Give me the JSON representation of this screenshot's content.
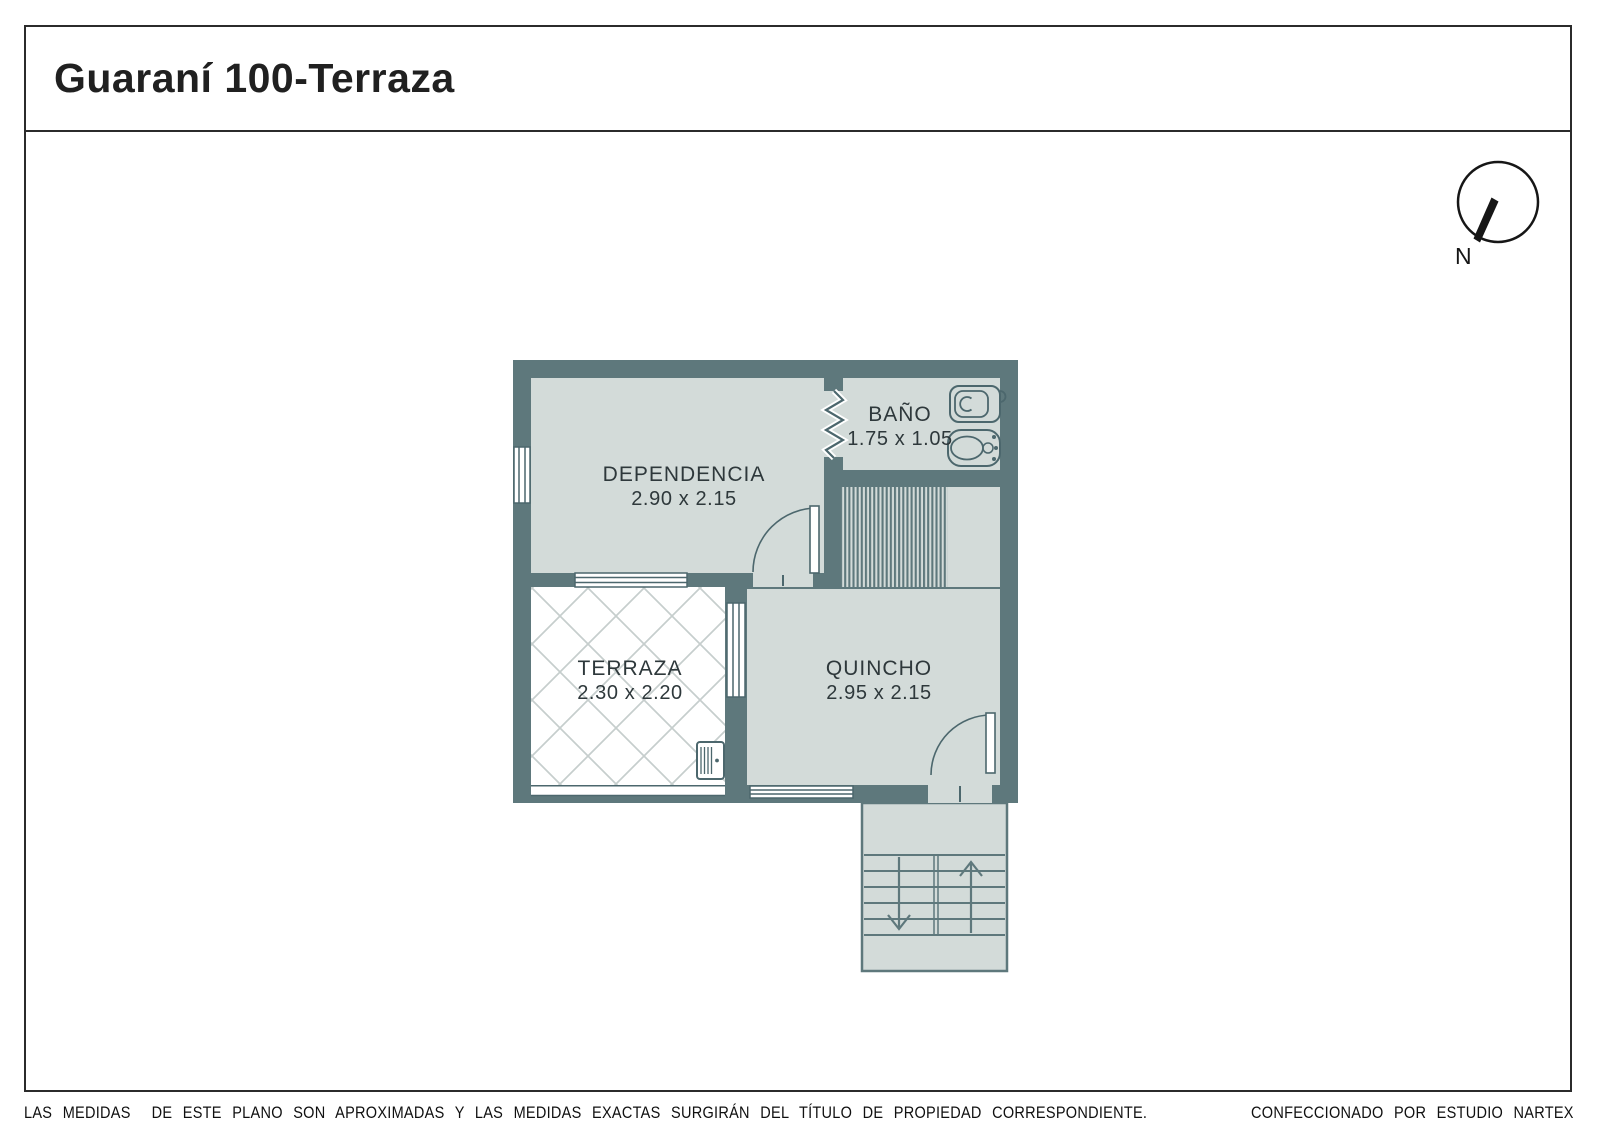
{
  "title": "Guaraní 100-Terraza",
  "compass": {
    "north_label": "N"
  },
  "rooms": [
    {
      "id": "dependencia",
      "name": "DEPENDENCIA",
      "dimensions": "2.90 x 2.15"
    },
    {
      "id": "bano",
      "name": "BAÑO",
      "dimensions": "1.75 x 1.05"
    },
    {
      "id": "terraza",
      "name": "TERRAZA",
      "dimensions": "2.30 x 2.20"
    },
    {
      "id": "quincho",
      "name": "QUINCHO",
      "dimensions": "2.95 x 2.15"
    }
  ],
  "footer": {
    "disclaimer": "LAS MEDIDAS  DE ESTE PLANO SON APROXIMADAS Y LAS MEDIDAS EXACTAS SURGIRÁN DEL TÍTULO DE PROPIEDAD CORRESPONDIENTE.",
    "credit": "CONFECCIONADO POR ESTUDIO NARTEX"
  },
  "colors": {
    "wall": "#5e787c",
    "floor": "#d3dbd9",
    "outline": "#4c676d",
    "hatch": "#c6cecd",
    "label": "#2e383b",
    "border": "#2b2b2b"
  }
}
